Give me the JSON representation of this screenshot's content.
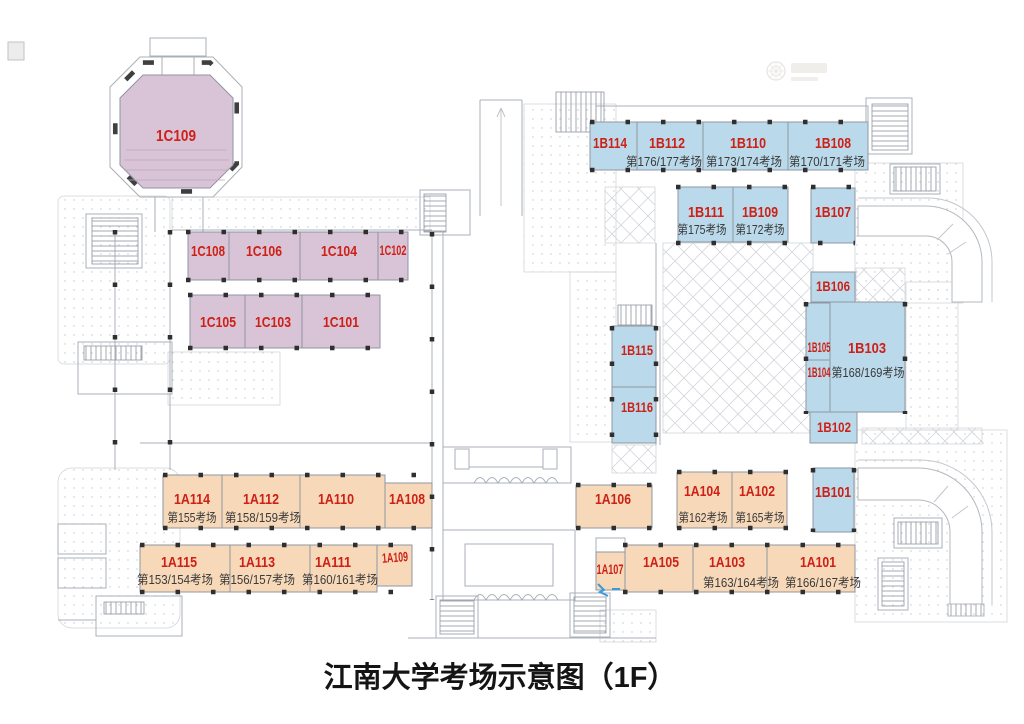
{
  "title": "江南大学考场示意图（1F）",
  "watermark": {
    "icon": "faint-company-seal-logo"
  },
  "zones": {
    "zone_a_fill": "#f7d9b9",
    "zone_b_fill": "#badaeb",
    "zone_c_fill": "#d9c3d7",
    "room_label_color": "#cd2016",
    "exam_text_color": "#3a3a3a",
    "plan_line_color": "#aab0b8",
    "column_color": "#2f2f2f"
  },
  "rooms": [
    {
      "id": "1C109"
    },
    {
      "id": "1C108"
    },
    {
      "id": "1C106"
    },
    {
      "id": "1C104"
    },
    {
      "id": "1C102"
    },
    {
      "id": "1C105"
    },
    {
      "id": "1C103"
    },
    {
      "id": "1C101"
    },
    {
      "id": "1B114"
    },
    {
      "id": "1B112",
      "exam": "第176/177考场"
    },
    {
      "id": "1B110",
      "exam": "第173/174考场"
    },
    {
      "id": "1B108",
      "exam": "第170/171考场"
    },
    {
      "id": "1B111",
      "exam": "第175考场"
    },
    {
      "id": "1B109",
      "exam": "第172考场"
    },
    {
      "id": "1B107"
    },
    {
      "id": "1B106"
    },
    {
      "id": "1B105"
    },
    {
      "id": "1B103",
      "exam": "第168/169考场"
    },
    {
      "id": "1B104"
    },
    {
      "id": "1B102"
    },
    {
      "id": "1B115"
    },
    {
      "id": "1B116"
    },
    {
      "id": "1B101"
    },
    {
      "id": "1A114",
      "exam": "第155考场"
    },
    {
      "id": "1A112",
      "exam": "第158/159考场"
    },
    {
      "id": "1A110"
    },
    {
      "id": "1A108"
    },
    {
      "id": "1A115",
      "exam": "第153/154考场"
    },
    {
      "id": "1A113",
      "exam": "第156/157考场"
    },
    {
      "id": "1A111",
      "exam": "第160/161考场"
    },
    {
      "id": "1A109"
    },
    {
      "id": "1A106"
    },
    {
      "id": "1A104",
      "exam": "第162考场"
    },
    {
      "id": "1A102",
      "exam": "第165考场"
    },
    {
      "id": "1A107"
    },
    {
      "id": "1A105"
    },
    {
      "id": "1A103",
      "exam": "第163/164考场"
    },
    {
      "id": "1A101",
      "exam": "第166/167考场"
    }
  ]
}
